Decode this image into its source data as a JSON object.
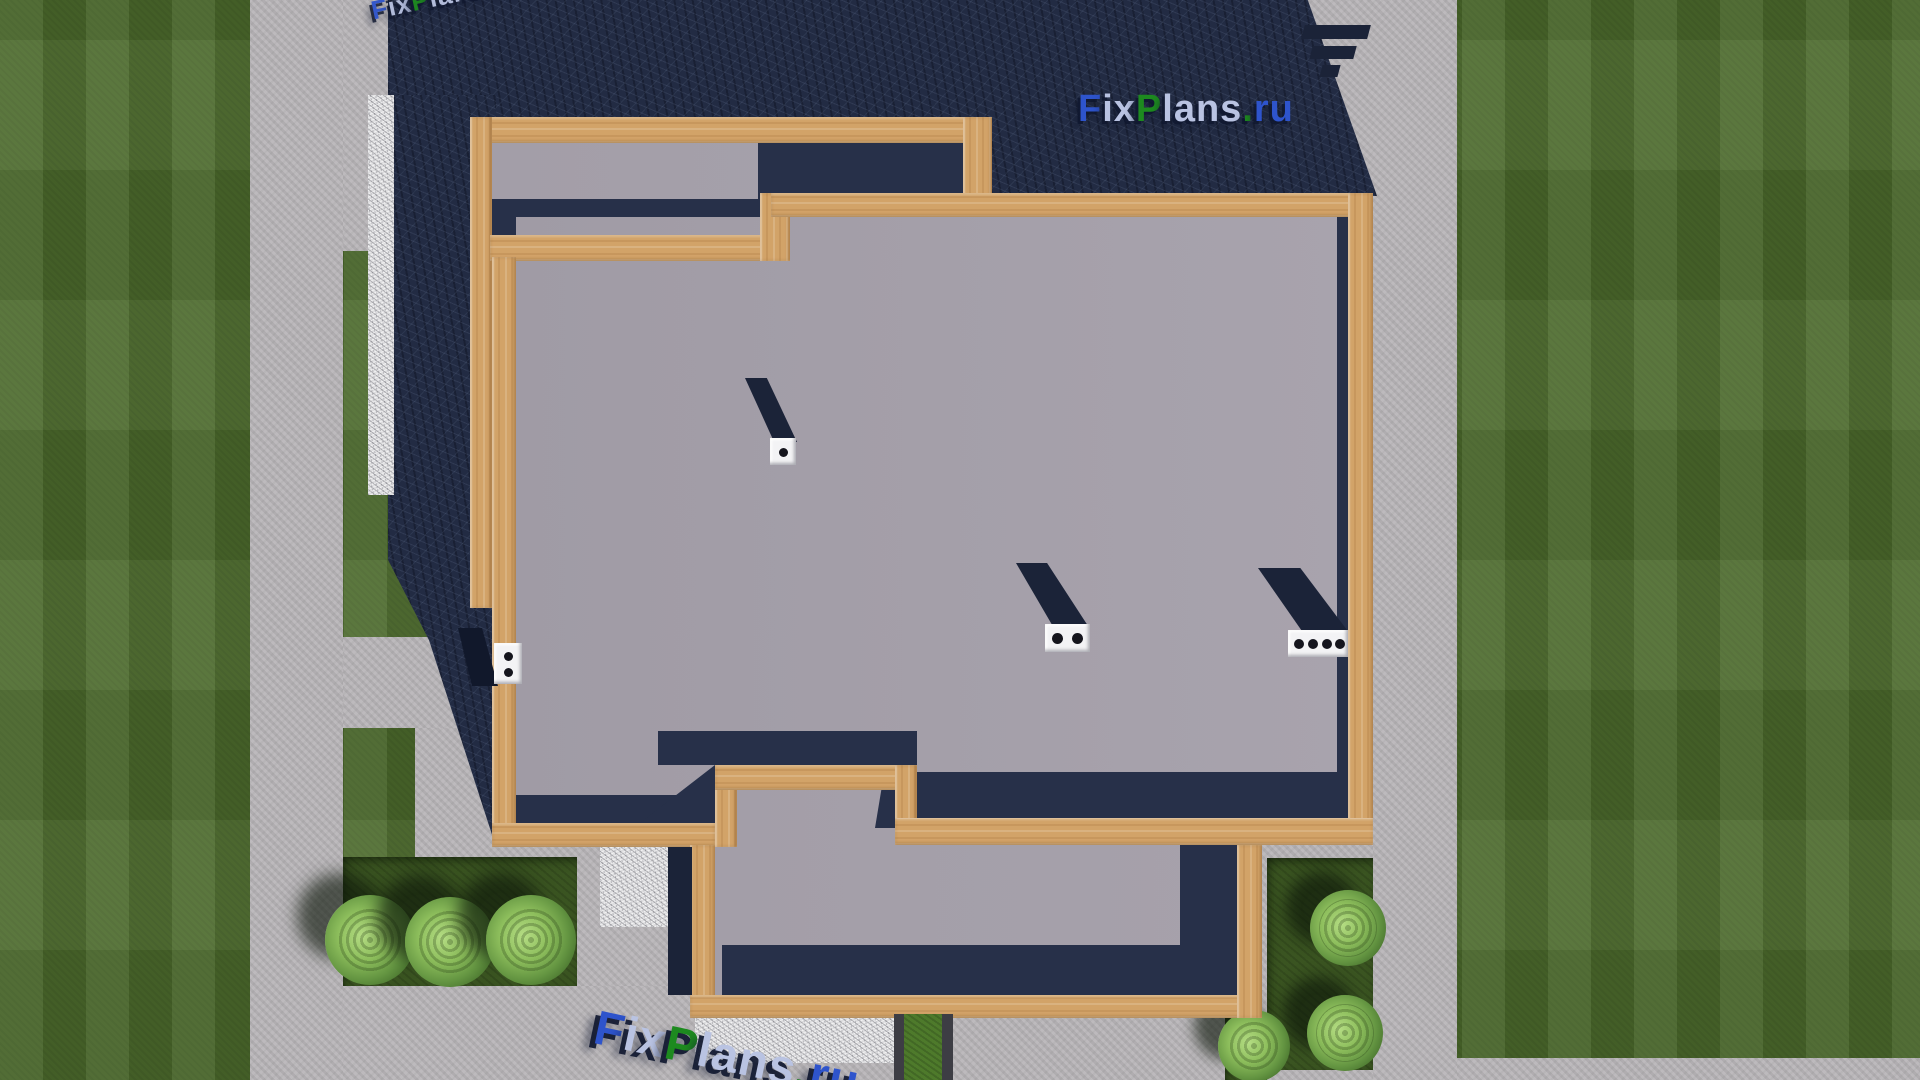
{
  "watermark": {
    "text": "FixPlans.ru",
    "segments": [
      {
        "text": "F",
        "color": "#2e54cc"
      },
      {
        "text": "ix",
        "color": "#b9c3e2"
      },
      {
        "text": "P",
        "color": "#1d8a1f"
      },
      {
        "text": "lans",
        "color": "#b9c3e2"
      },
      {
        "text": ".",
        "color": "#1d8a1f"
      },
      {
        "text": "ru",
        "color": "#2e54cc"
      }
    ],
    "shadow_color": "#141d3a"
  },
  "palette": {
    "grass": "#4c6a2c",
    "dark_grass_bed": "#3a5421",
    "concrete": "#b8b5b8",
    "shadow_navy": "#222b43",
    "roof_gray": "#a29da7",
    "wood_trim": "#d2a368",
    "gravel": "#dddddf",
    "bush_green": "#8dbe5c",
    "vent_white": "#f3f3f5",
    "logo_blue": "#2e54cc",
    "logo_green": "#1d8a1f",
    "logo_pale": "#b9c3e2"
  }
}
